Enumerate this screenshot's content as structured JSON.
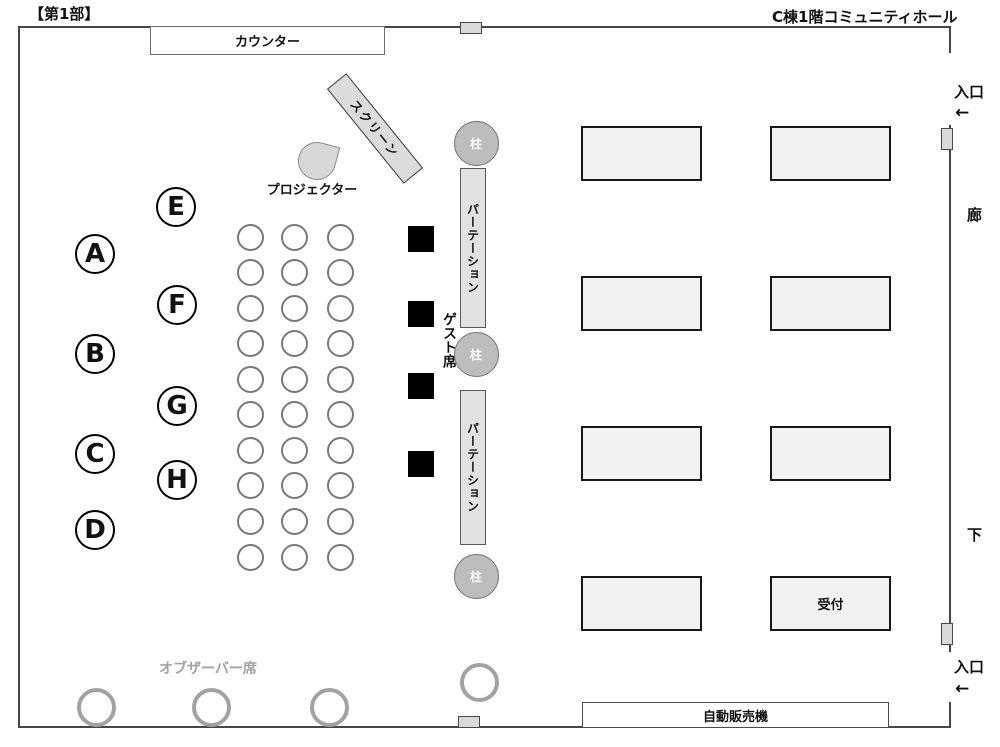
{
  "header": {
    "part_label": "【第1部】",
    "hall_label": "C棟1階コミュニティホール"
  },
  "labels": {
    "counter": "カウンター",
    "screen": "スクリーン",
    "projector": "プロジェクター",
    "pillar": "柱",
    "partition": "パーテーション",
    "guest_seats": "ゲスト席",
    "observer_seats": "オブザーバー席",
    "reception": "受付",
    "vending_machine": "自動販売機",
    "entrance": "入口",
    "corridor_char_top": "廊",
    "corridor_char_bottom": "下",
    "arrow_left": "←"
  },
  "seat_blocks": {
    "left_letters": [
      "A",
      "B",
      "C",
      "D"
    ],
    "right_letters": [
      "E",
      "F",
      "G",
      "H"
    ]
  },
  "chair_grid": {
    "rows": 10,
    "cols": 3
  },
  "guest_seat_squares": {
    "count": 4
  },
  "pillars": {
    "count": 3
  },
  "partitions": {
    "count": 2
  },
  "tables": {
    "rows": 4,
    "cols": 2,
    "reception_table": {
      "row": 4,
      "col": 2
    }
  },
  "observer_circles": {
    "count": 4
  },
  "colors": {
    "wall": "#474747",
    "table_fill": "#f2f2f2",
    "partition_fill": "#e2e2e2",
    "pillar_fill": "#bdbdbd",
    "guest_square": "#000000",
    "observer_gray": "#a2a2a2",
    "screen_fill": "#dcdcdc"
  }
}
